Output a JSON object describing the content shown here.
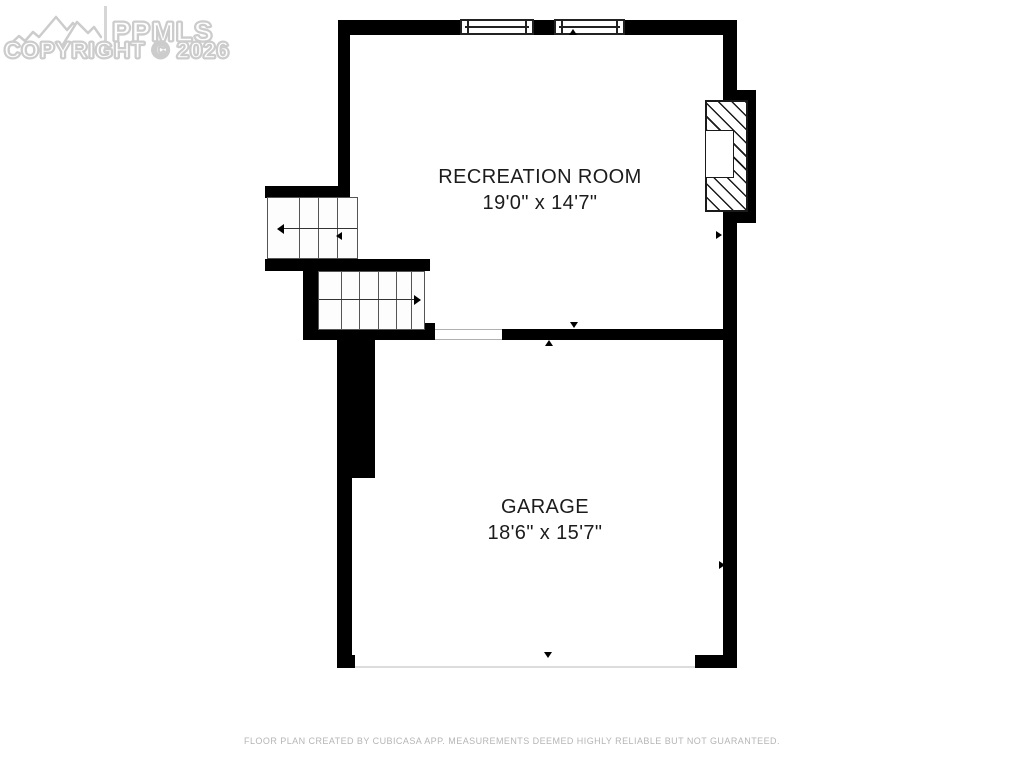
{
  "watermark": {
    "brand": "PPMLS",
    "copyright": "COPYRIGHT © 2026"
  },
  "rooms": [
    {
      "name": "RECREATION ROOM",
      "dimensions": "19'0\" x 14'7\""
    },
    {
      "name": "GARAGE",
      "dimensions": "18'6\" x 15'7\""
    }
  ],
  "footer": {
    "disclaimer": "FLOOR PLAN CREATED BY CUBICASA APP. MEASUREMENTS DEEMED HIGHLY RELIABLE BUT NOT GUARANTEED."
  },
  "icons": {
    "mountain-logo-icon": "outlined mountain range",
    "window-icon": "double-line window symbol",
    "fireplace-icon": "diagonal-hatched chimney block",
    "stair-arrow-icon": "travel-direction arrow",
    "wall-marker-icon": "small black triangle"
  },
  "colors": {
    "wall": "#000000",
    "background": "#ffffff",
    "watermark": "#cccccc",
    "label_text": "#1c1c1c",
    "footer_text": "#b5b5b5",
    "garage_door_line": "#dcdcdc"
  }
}
